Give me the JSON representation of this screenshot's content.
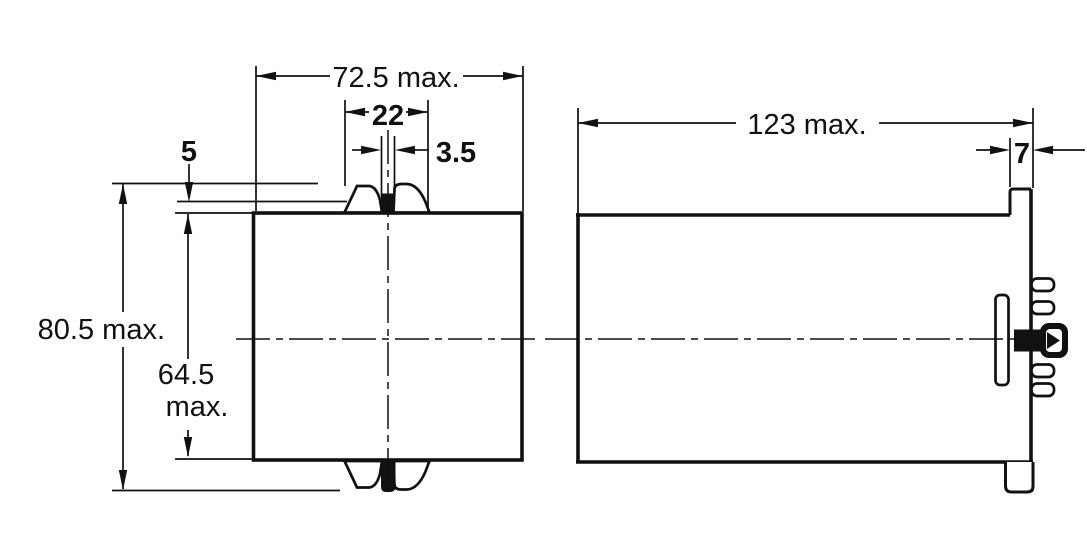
{
  "drawing": {
    "type": "mechanical-dimension-drawing",
    "units_note": "millimetres",
    "views": {
      "front": {
        "label": "front-view",
        "dimensions": {
          "width": "72.5 max.",
          "latch_span": "22",
          "slot": "3.5",
          "hook": "5",
          "overall_height": "80.5 max.",
          "body_height_value": "64.5",
          "body_height_suffix": "max."
        }
      },
      "side": {
        "label": "side-view",
        "dimensions": {
          "depth": "123 max.",
          "rear_tab": "7"
        }
      }
    },
    "colors": {
      "ink": "#111111",
      "paper": "#ffffff"
    }
  }
}
